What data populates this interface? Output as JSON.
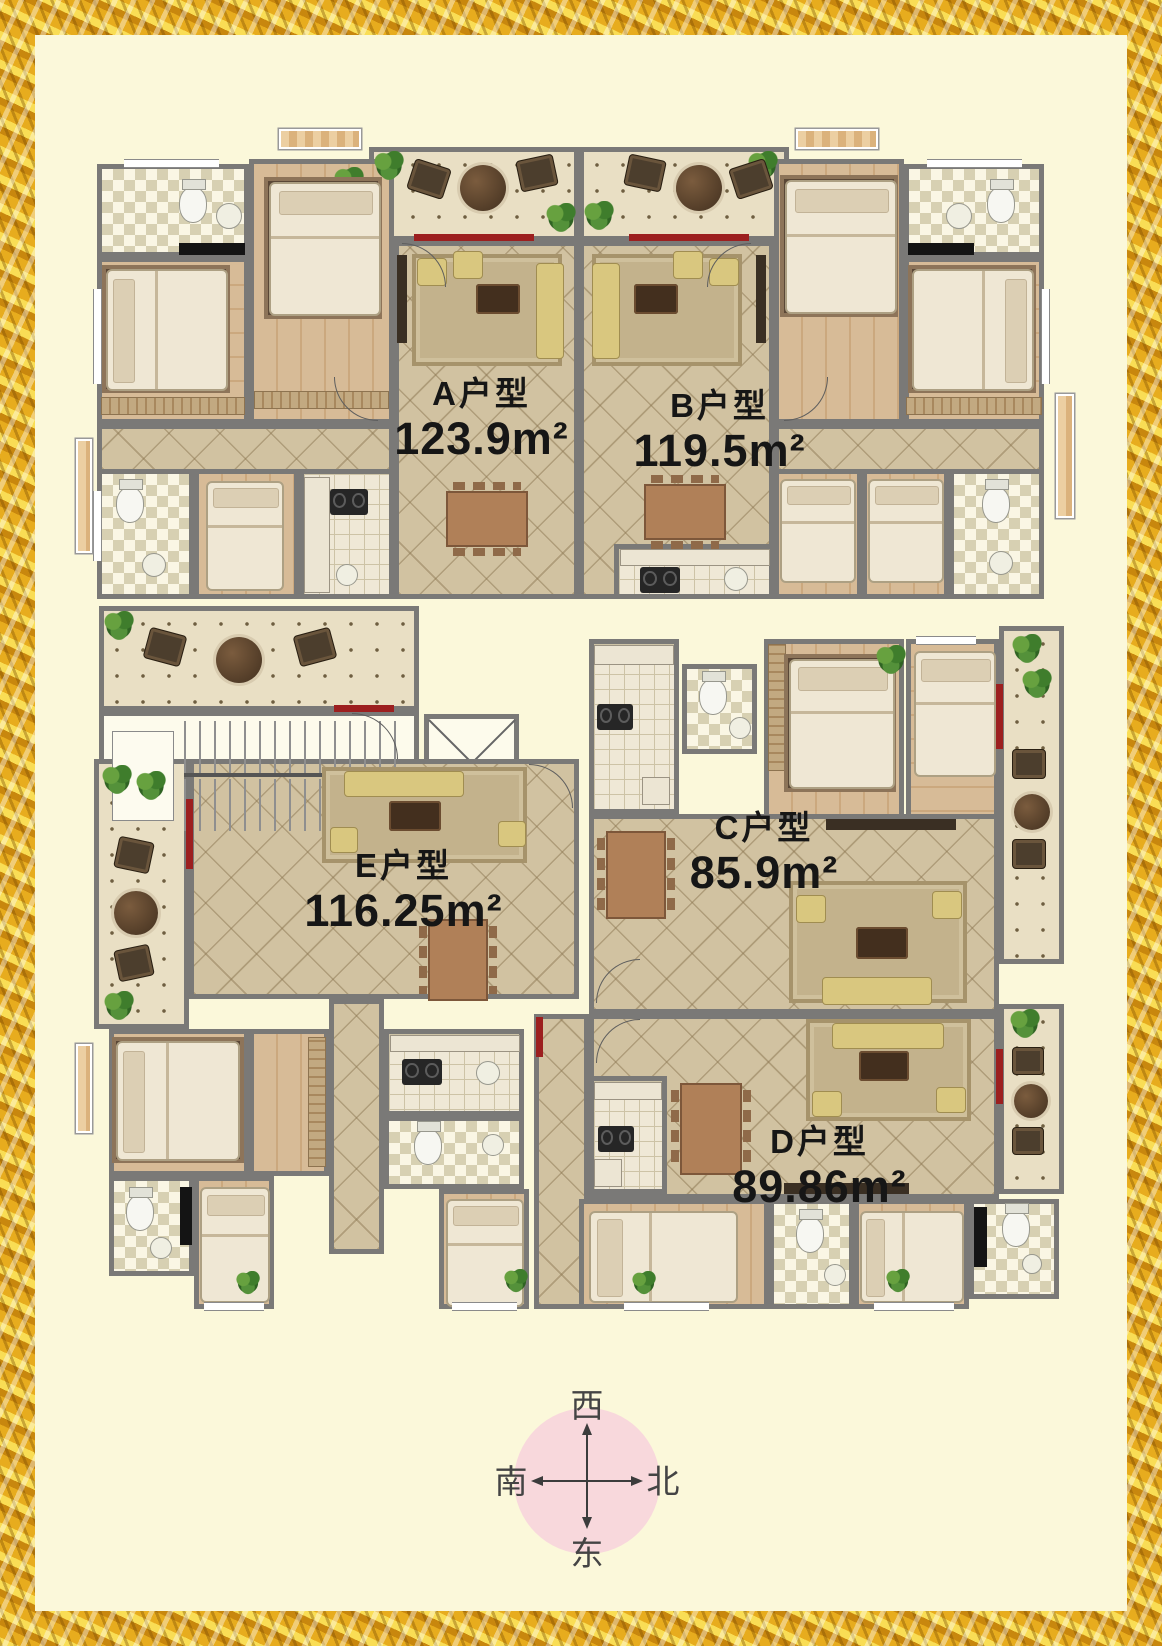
{
  "poster": {
    "background_color": "#fbf8da",
    "frame_color": "#e7ac1e",
    "wall_color": "#7a7977",
    "accent_red": "#9c1f1f",
    "compass_circle_color": "#f8d8dc"
  },
  "floorplan": {
    "units": [
      {
        "id": "A",
        "name": "A户型",
        "area": "123.9m²"
      },
      {
        "id": "B",
        "name": "B户型",
        "area": "119.5m²"
      },
      {
        "id": "C",
        "name": "C户型",
        "area": "85.9m²"
      },
      {
        "id": "D",
        "name": "D户型",
        "area": "89.86m²"
      },
      {
        "id": "E",
        "name": "E户型",
        "area": "116.25m²"
      }
    ]
  },
  "compass": {
    "top": "西",
    "bottom": "东",
    "left": "南",
    "right": "北"
  }
}
